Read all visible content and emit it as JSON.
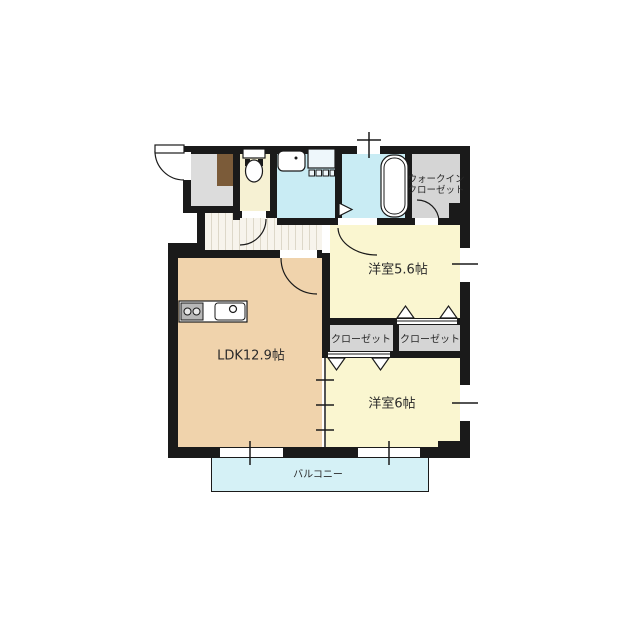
{
  "floorplan": {
    "rooms": {
      "ldk": {
        "label": "LDK12.9帖"
      },
      "bedroom1": {
        "label": "洋室5.6帖"
      },
      "bedroom2": {
        "label": "洋室6帖"
      },
      "closet_left": {
        "label": "クローゼット"
      },
      "closet_right": {
        "label": "クローゼット"
      },
      "walk_in_closet": {
        "label_line1": "ウォークイン",
        "label_line2": "クローゼット"
      },
      "balcony": {
        "label": "バルコニー"
      }
    },
    "fixtures": {
      "kitchen": "kitchen-counter-with-stove-and-sink",
      "bath": "bathtub",
      "sanitary": "toilet",
      "laundry": "washer-space",
      "wash": "vanity-sink"
    },
    "colors": {
      "wall": "#1a1a1a",
      "ldk_floor": "#f0d3ac",
      "bedroom_floor": "#faf6d0",
      "toilet_floor": "#f6f1d3",
      "wet_area_floor": "#c9ecf4",
      "balcony_floor": "#d5f1f6",
      "closet_floor": "#d5d5d5",
      "entry_floor": "#dcdcdc",
      "shoe_cabinet": "#7b5b39"
    }
  }
}
